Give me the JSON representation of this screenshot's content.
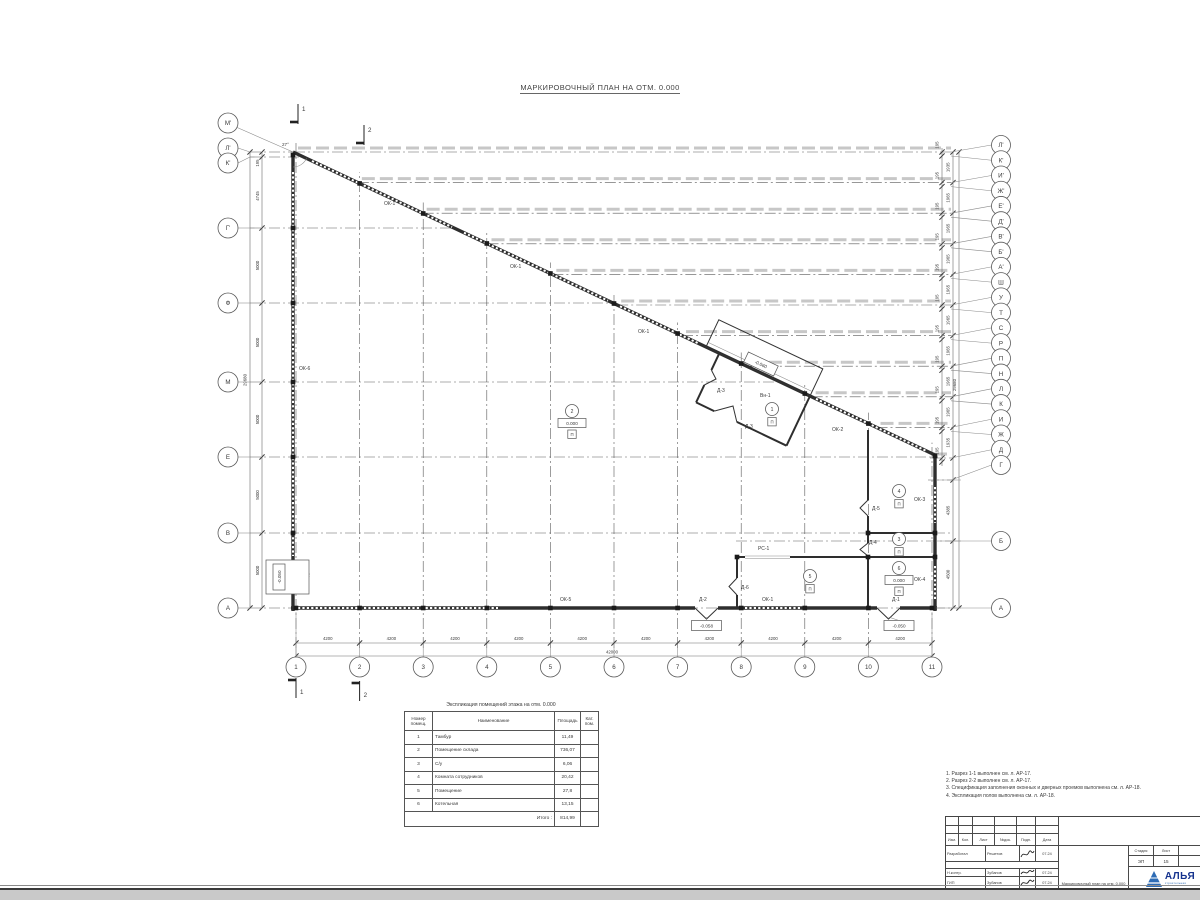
{
  "title": "МАРКИРОВОЧНЫЙ ПЛАН НА ОТМ. 0.000",
  "plan": {
    "angle": "27°",
    "sections": {
      "s1": "1",
      "s2": "2"
    },
    "axes_left": [
      "М'",
      "Л'",
      "К'",
      "Г'",
      "Ф",
      "М",
      "Е",
      "В",
      "А"
    ],
    "axes_right": [
      "Л'",
      "К'",
      "И'",
      "Ж'",
      "Е'",
      "Д'",
      "В'",
      "Б'",
      "А'",
      "Ш",
      "У",
      "Т",
      "С",
      "Р",
      "П",
      "Н",
      "Л",
      "К",
      "И",
      "Ж",
      "Д",
      "Г",
      "Б",
      "А"
    ],
    "axes_bottom": [
      "1",
      "2",
      "3",
      "4",
      "5",
      "6",
      "7",
      "8",
      "9",
      "10",
      "11"
    ],
    "dims": {
      "bottom": [
        "4200",
        "4200",
        "4200",
        "4200",
        "4200",
        "4200",
        "4200",
        "4200",
        "4200",
        "4200"
      ],
      "bottom_total": "42000",
      "left": [
        "195",
        "4745",
        "5000",
        "5000",
        "5000",
        "5000",
        "5000"
      ],
      "left_total": "29680",
      "right_small": "195",
      "right_bays": [
        "1935",
        "1965",
        "1965",
        "1965",
        "1965",
        "1965",
        "1965",
        "1965",
        "1965",
        "1935"
      ],
      "right_lower": [
        "4385",
        "4500"
      ],
      "right_total": "29680"
    },
    "marks": {
      "ok1": "ОК-1",
      "ok2": "ОК-2",
      "ok3": "ОК-3",
      "ok4": "ОК-4",
      "ok5": "ОК-5",
      "ok6": "ОК-6",
      "d1": "Д-1",
      "d2": "Д-2",
      "d3": "Д-3",
      "d4": "Д-4",
      "d5": "Д-5",
      "d6": "Д-6",
      "rs1": "РС-1",
      "vn1": "Вн-1"
    },
    "elevations": {
      "zero": "0.000",
      "m050": "-0.050",
      "m058": "-0.058",
      "m060": "-0.060"
    },
    "rooms": [
      {
        "num": "1",
        "floor": "П"
      },
      {
        "num": "2",
        "floor": "П",
        "elev": "0.000"
      },
      {
        "num": "3",
        "floor": "П"
      },
      {
        "num": "4",
        "floor": "П"
      },
      {
        "num": "5",
        "floor": "П"
      },
      {
        "num": "6",
        "floor": "П",
        "elev": "0.000"
      }
    ]
  },
  "table": {
    "title": "Экспликация помещений этажа на отм. 0.000",
    "headers": [
      "Номер помещ.",
      "Наименование",
      "Площадь",
      "Кат. пом."
    ],
    "rows": [
      [
        "1",
        "Тамбур",
        "11,49"
      ],
      [
        "2",
        "Помещение склада",
        "736,07"
      ],
      [
        "3",
        "С/у",
        "6,06"
      ],
      [
        "4",
        "Комната сотрудников",
        "20,42"
      ],
      [
        "5",
        "Помещение",
        "27,8"
      ],
      [
        "6",
        "Котельная",
        "13,15"
      ]
    ],
    "total_label": "Итого :",
    "total": "814,99"
  },
  "notes": [
    "1. Разрез 1-1 выполнен см. л. АР-17.",
    "2. Разрез 2-2 выполнен см. л. АР-17.",
    "3. Спецификация заполнения оконных и дверных проемов выполнена см. л. АР-18.",
    "4. Экспликация полов выполнена см. л. АР-18."
  ],
  "titleblock": {
    "change_headers": [
      "Изм.",
      "Кол.",
      "Лист",
      "№док.",
      "Подп.",
      "Дата"
    ],
    "rows": [
      {
        "role": "Разработал",
        "name": "Решетов",
        "date": "07.24"
      },
      {
        "role": "Н.контр.",
        "name": "Зубанов",
        "date": "07.24"
      },
      {
        "role": "ГИП",
        "name": "Зубанов",
        "date": "07.24"
      }
    ],
    "doc_title": "Маркировочный план на отм. 0.000",
    "stage_label": "Стадия",
    "sheet_label": "Лист",
    "stage": "ЭП",
    "sheet": "15",
    "logo_text": "АЛЬЯ",
    "logo_sub": "строительная"
  }
}
